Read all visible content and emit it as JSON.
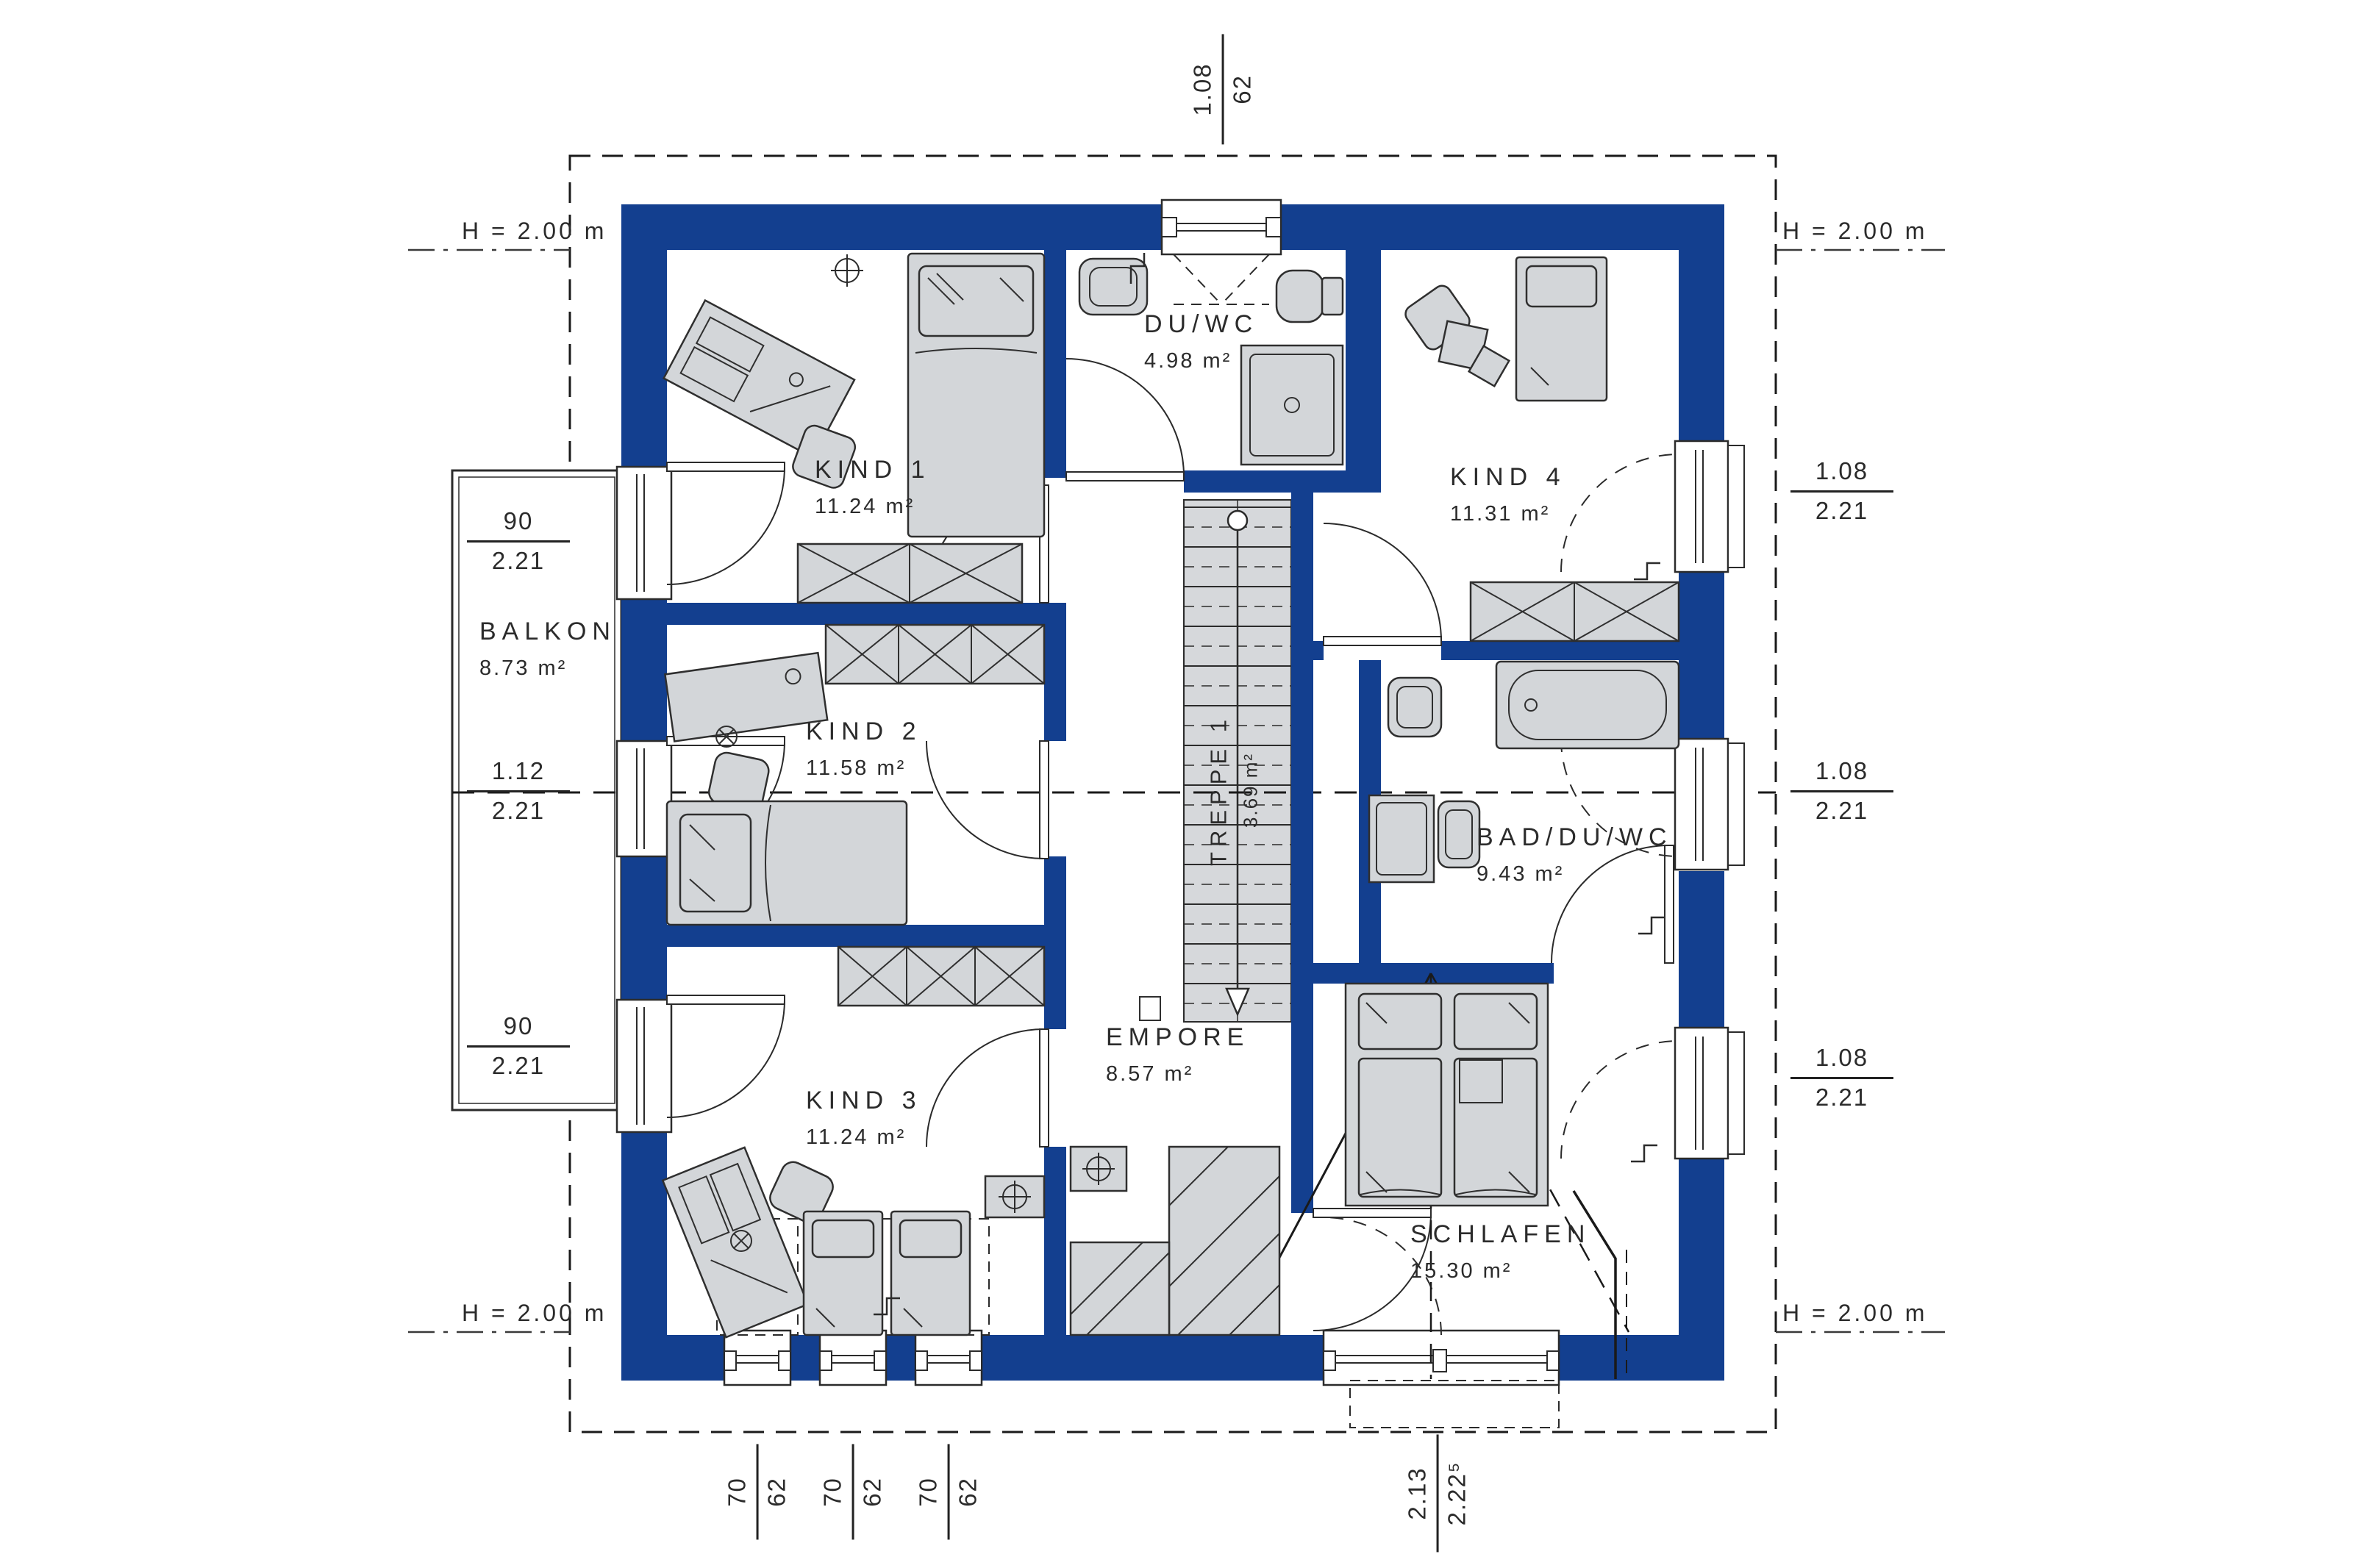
{
  "colors": {
    "wall": "#133F8F",
    "furniture_fill": "#D3D6D9",
    "line": "#2B2B2B"
  },
  "rooms": [
    {
      "id": "kind1",
      "name": "KIND 1",
      "area": "11.24 m²"
    },
    {
      "id": "duwc",
      "name": "DU/WC",
      "area": "4.98 m²"
    },
    {
      "id": "kind4",
      "name": "KIND 4",
      "area": "11.31 m²"
    },
    {
      "id": "kind2",
      "name": "KIND 2",
      "area": "11.58 m²"
    },
    {
      "id": "badduwc",
      "name": "BAD/DU/WC",
      "area": "9.43 m²"
    },
    {
      "id": "kind3",
      "name": "KIND 3",
      "area": "11.24 m²"
    },
    {
      "id": "empore",
      "name": "EMPORE",
      "area": "8.57 m²"
    },
    {
      "id": "schlafen",
      "name": "SCHLAFEN",
      "area": "15.30 m²"
    },
    {
      "id": "balkon",
      "name": "BALKON",
      "area": "8.73 m²"
    },
    {
      "id": "treppe1",
      "name": "TREPPE 1",
      "area": "3.69 m²"
    }
  ],
  "dimensions": {
    "top": {
      "num": "1.08",
      "den": "62"
    },
    "left": [
      {
        "num": "90",
        "den": "2.21"
      },
      {
        "num": "1.12",
        "den": "2.21"
      },
      {
        "num": "90",
        "den": "2.21"
      }
    ],
    "right": [
      {
        "num": "1.08",
        "den": "2.21"
      },
      {
        "num": "1.08",
        "den": "2.21"
      },
      {
        "num": "1.08",
        "den": "2.21"
      }
    ],
    "bottom": [
      {
        "num": "70",
        "den": "62"
      },
      {
        "num": "70",
        "den": "62"
      },
      {
        "num": "70",
        "den": "62"
      },
      {
        "num": "2.13",
        "den": "2.22⁵"
      }
    ]
  },
  "height": {
    "label": "H = 2.00 m"
  }
}
